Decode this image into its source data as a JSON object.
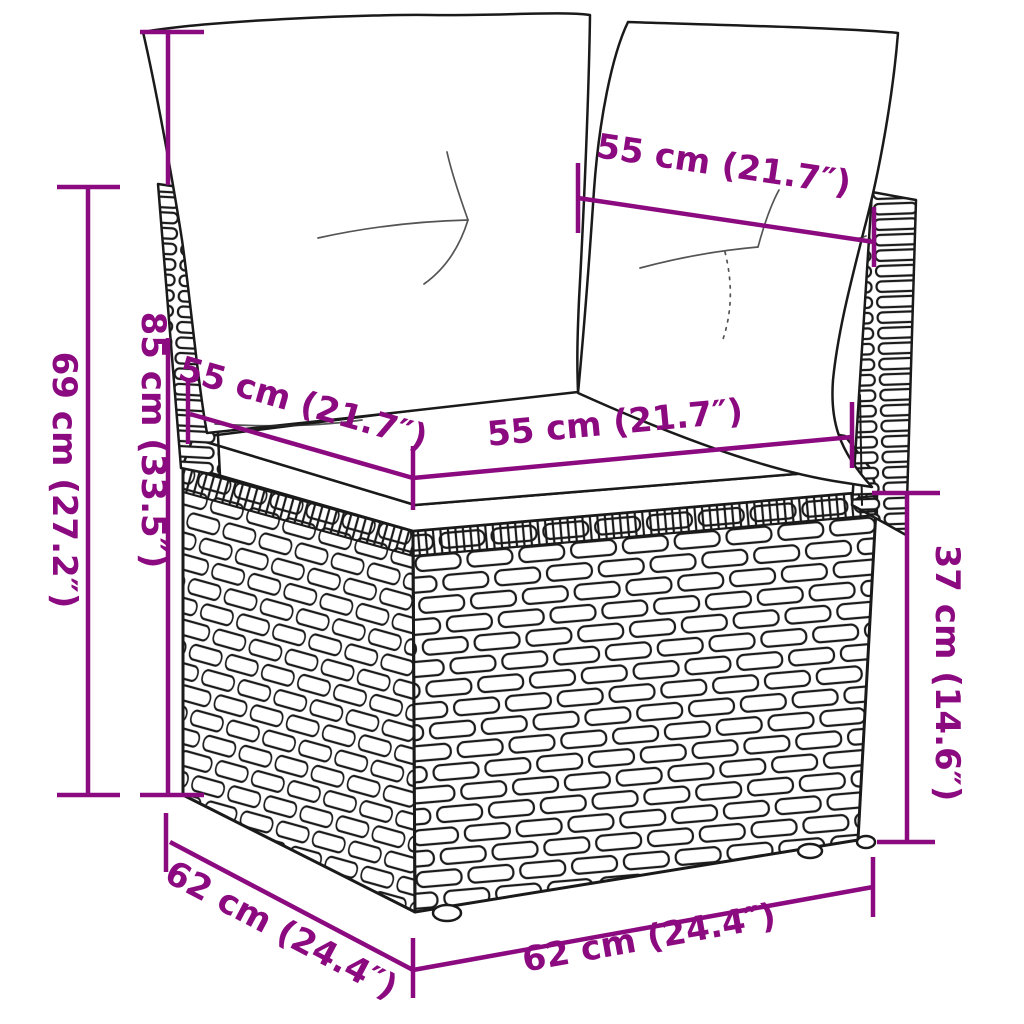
{
  "title": "Corner sofa section with cushions - dimension diagram",
  "colors": {
    "dimension_accent": "#8C0A80",
    "line_art": "#1a1a1a",
    "background": "#FFFFFF"
  },
  "dimensions": {
    "back_width_top": "55 cm (21.7″)",
    "seat_depth_left": "55 cm (21.7″)",
    "seat_width_front": "55 cm (21.7″)",
    "total_height": "85 cm (33.5″)",
    "backrest_height": "69 cm (27.2″)",
    "seat_height": "37 cm (14.6″)",
    "base_depth_left": "62 cm (24.4″)",
    "base_width_front": "62 cm (24.4″)"
  }
}
